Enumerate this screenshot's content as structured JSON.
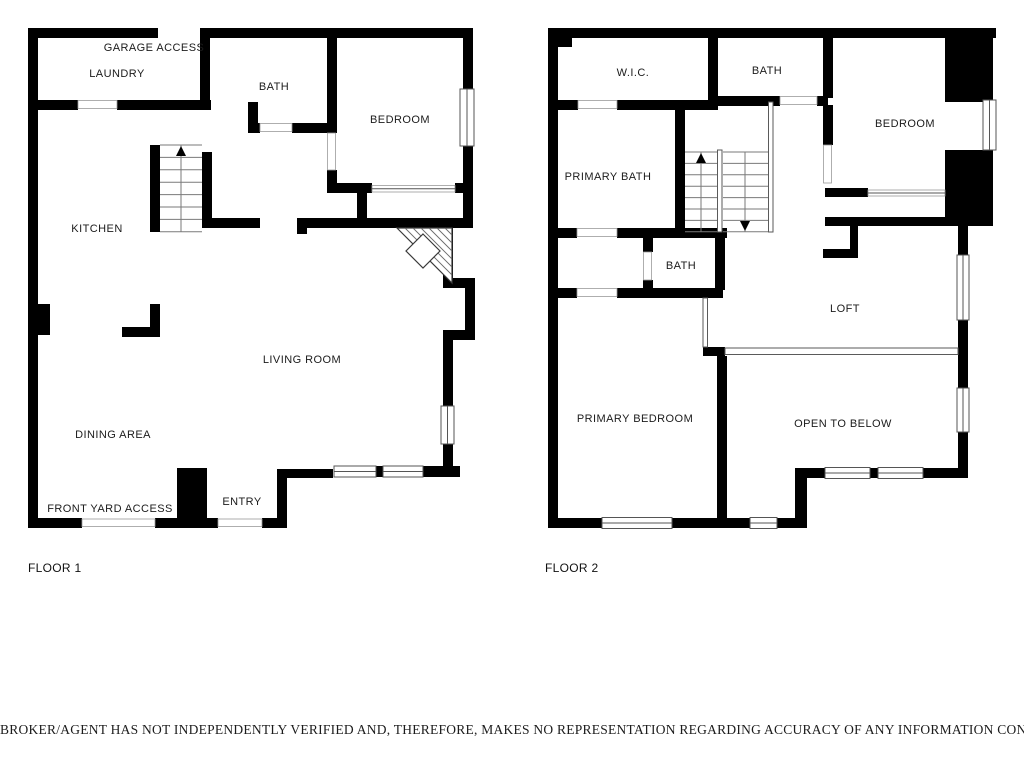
{
  "floor1": {
    "name": "FLOOR 1",
    "labels": {
      "garage_access": "GARAGE ACCESS",
      "laundry": "LAUNDRY",
      "bath": "BATH",
      "bedroom": "BEDROOM",
      "kitchen": "KITCHEN",
      "living_room": "LIVING ROOM",
      "dining_area": "DINING AREA",
      "front_yard_access": "FRONT YARD ACCESS",
      "entry": "ENTRY"
    }
  },
  "floor2": {
    "name": "FLOOR 2",
    "labels": {
      "wic": "W.I.C.",
      "bath_top": "BATH",
      "bedroom": "BEDROOM",
      "primary_bath": "PRIMARY BATH",
      "bath_mid": "BATH",
      "loft": "LOFT",
      "primary_bedroom": "PRIMARY BEDROOM",
      "open_to_below": "OPEN TO BELOW"
    }
  },
  "disclaimer": "BROKER/AGENT HAS NOT INDEPENDENTLY VERIFIED AND, THEREFORE, MAKES NO REPRESENTATION REGARDING ACCURACY OF ANY INFORMATION CONTAINED HEREIN.",
  "colors": {
    "wall": "#000000",
    "background": "#ffffff",
    "text": "#1b1b1b"
  }
}
